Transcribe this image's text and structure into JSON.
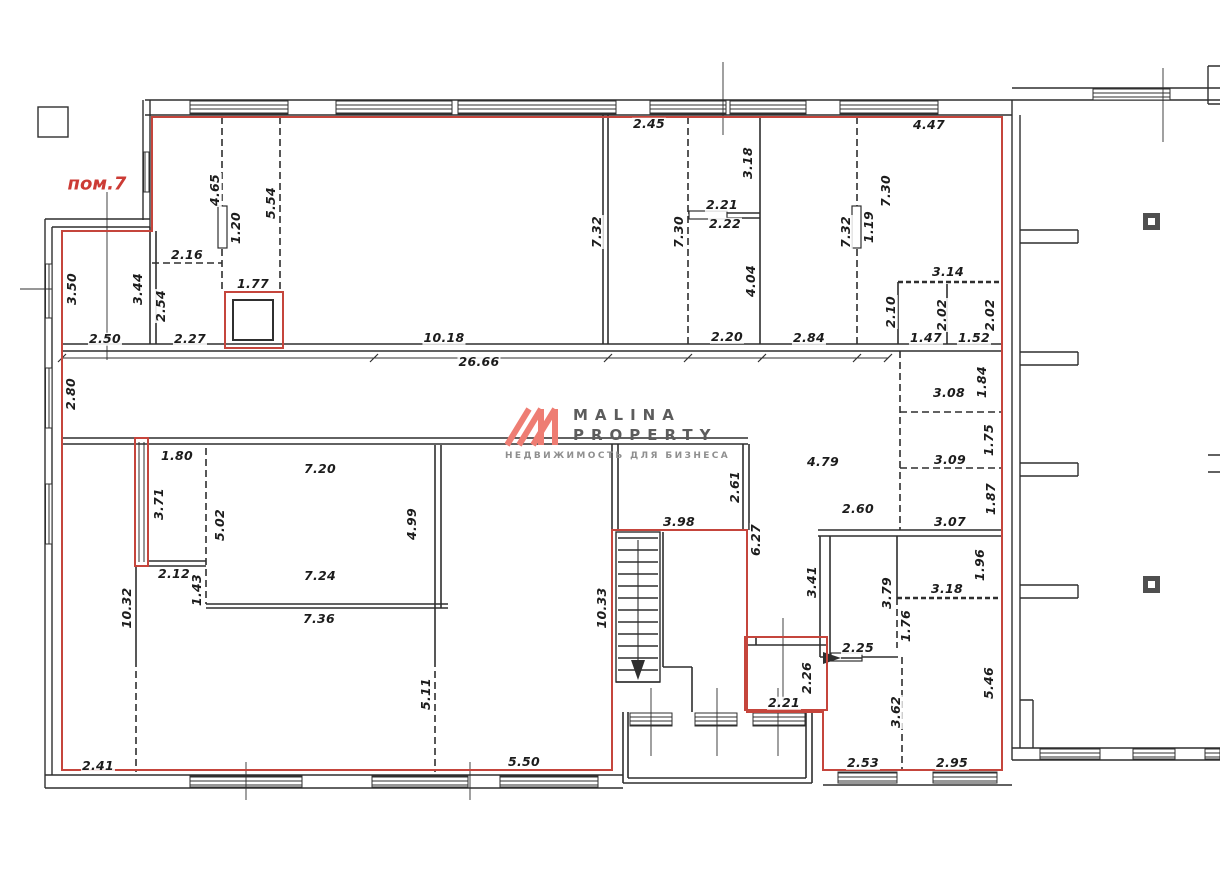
{
  "plan": {
    "premises_label": "пом.7"
  },
  "logo": {
    "line1": "MALINA",
    "line2": "PROPERTY",
    "tagline": "НЕДВИЖИМОСТЬ ДЛЯ БИЗНЕСА",
    "mark_color": "#ee7d73",
    "text_color": "#5c5c5c"
  },
  "colors": {
    "boundary_red": "#c5453c",
    "wall_black": "#2f2f2f"
  },
  "labels": [
    {
      "text": "2.45",
      "x": 649,
      "y": 124,
      "rot": 0
    },
    {
      "text": "4.47",
      "x": 929,
      "y": 125,
      "rot": 0
    },
    {
      "text": "3.18",
      "x": 748,
      "y": 163,
      "rot": 1
    },
    {
      "text": "2.21",
      "x": 722,
      "y": 205,
      "rot": 0
    },
    {
      "text": "2.22",
      "x": 725,
      "y": 224,
      "rot": 0
    },
    {
      "text": "4.04",
      "x": 751,
      "y": 281,
      "rot": 1
    },
    {
      "text": "7.30",
      "x": 679,
      "y": 232,
      "rot": 1
    },
    {
      "text": "7.32",
      "x": 597,
      "y": 232,
      "rot": 1
    },
    {
      "text": "7.32",
      "x": 846,
      "y": 232,
      "rot": 1
    },
    {
      "text": "1.19",
      "x": 869,
      "y": 227,
      "rot": 1
    },
    {
      "text": "7.30",
      "x": 886,
      "y": 191,
      "rot": 1
    },
    {
      "text": "3.14",
      "x": 948,
      "y": 272,
      "rot": 0
    },
    {
      "text": "2.10",
      "x": 891,
      "y": 312,
      "rot": 1
    },
    {
      "text": "2.02",
      "x": 942,
      "y": 315,
      "rot": 1
    },
    {
      "text": "2.02",
      "x": 990,
      "y": 315,
      "rot": 1
    },
    {
      "text": "1.47",
      "x": 926,
      "y": 338,
      "rot": 0
    },
    {
      "text": "1.52",
      "x": 974,
      "y": 338,
      "rot": 0
    },
    {
      "text": "2.20",
      "x": 727,
      "y": 337,
      "rot": 0
    },
    {
      "text": "2.84",
      "x": 809,
      "y": 338,
      "rot": 0
    },
    {
      "text": "4.65",
      "x": 215,
      "y": 190,
      "rot": 1
    },
    {
      "text": "1.20",
      "x": 236,
      "y": 228,
      "rot": 1
    },
    {
      "text": "5.54",
      "x": 271,
      "y": 203,
      "rot": 1
    },
    {
      "text": "2.16",
      "x": 187,
      "y": 255,
      "rot": 0
    },
    {
      "text": "1.77",
      "x": 253,
      "y": 284,
      "rot": 0
    },
    {
      "text": "3.50",
      "x": 72,
      "y": 289,
      "rot": 1
    },
    {
      "text": "3.44",
      "x": 138,
      "y": 289,
      "rot": 1
    },
    {
      "text": "2.54",
      "x": 161,
      "y": 306,
      "rot": 1
    },
    {
      "text": "2.50",
      "x": 105,
      "y": 339,
      "rot": 0
    },
    {
      "text": "2.27",
      "x": 190,
      "y": 339,
      "rot": 0
    },
    {
      "text": "10.18",
      "x": 444,
      "y": 338,
      "rot": 0
    },
    {
      "text": "26.66",
      "x": 479,
      "y": 362,
      "rot": 0
    },
    {
      "text": "2.80",
      "x": 71,
      "y": 394,
      "rot": 1
    },
    {
      "text": "3.08",
      "x": 949,
      "y": 393,
      "rot": 0
    },
    {
      "text": "1.84",
      "x": 982,
      "y": 382,
      "rot": 1
    },
    {
      "text": "3.09",
      "x": 950,
      "y": 460,
      "rot": 0
    },
    {
      "text": "1.75",
      "x": 989,
      "y": 440,
      "rot": 1
    },
    {
      "text": "3.07",
      "x": 950,
      "y": 522,
      "rot": 0
    },
    {
      "text": "1.87",
      "x": 991,
      "y": 499,
      "rot": 1
    },
    {
      "text": "1.80",
      "x": 177,
      "y": 456,
      "rot": 0
    },
    {
      "text": "3.71",
      "x": 159,
      "y": 504,
      "rot": 1
    },
    {
      "text": "5.02",
      "x": 220,
      "y": 525,
      "rot": 1
    },
    {
      "text": "7.20",
      "x": 320,
      "y": 469,
      "rot": 0
    },
    {
      "text": "4.99",
      "x": 412,
      "y": 524,
      "rot": 1
    },
    {
      "text": "2.12",
      "x": 174,
      "y": 574,
      "rot": 0
    },
    {
      "text": "1.43",
      "x": 197,
      "y": 590,
      "rot": 1
    },
    {
      "text": "7.24",
      "x": 320,
      "y": 576,
      "rot": 0
    },
    {
      "text": "7.36",
      "x": 319,
      "y": 619,
      "rot": 0
    },
    {
      "text": "10.32",
      "x": 127,
      "y": 608,
      "rot": 1
    },
    {
      "text": "2.61",
      "x": 735,
      "y": 487,
      "rot": 1
    },
    {
      "text": "3.98",
      "x": 679,
      "y": 522,
      "rot": 0
    },
    {
      "text": "6.27",
      "x": 756,
      "y": 540,
      "rot": 1
    },
    {
      "text": "4.79",
      "x": 823,
      "y": 462,
      "rot": 0
    },
    {
      "text": "2.60",
      "x": 858,
      "y": 509,
      "rot": 0
    },
    {
      "text": "10.33",
      "x": 602,
      "y": 608,
      "rot": 1
    },
    {
      "text": "3.41",
      "x": 812,
      "y": 582,
      "rot": 1
    },
    {
      "text": "3.79",
      "x": 887,
      "y": 593,
      "rot": 1
    },
    {
      "text": "3.18",
      "x": 947,
      "y": 589,
      "rot": 0
    },
    {
      "text": "1.96",
      "x": 980,
      "y": 565,
      "rot": 1
    },
    {
      "text": "1.76",
      "x": 906,
      "y": 626,
      "rot": 1
    },
    {
      "text": "2.25",
      "x": 858,
      "y": 648,
      "rot": 0
    },
    {
      "text": "2.26",
      "x": 807,
      "y": 678,
      "rot": 1
    },
    {
      "text": "2.21",
      "x": 784,
      "y": 703,
      "rot": 0
    },
    {
      "text": "3.62",
      "x": 896,
      "y": 712,
      "rot": 1
    },
    {
      "text": "5.46",
      "x": 989,
      "y": 683,
      "rot": 1
    },
    {
      "text": "2.53",
      "x": 863,
      "y": 763,
      "rot": 0
    },
    {
      "text": "2.95",
      "x": 952,
      "y": 763,
      "rot": 0
    },
    {
      "text": "5.11",
      "x": 426,
      "y": 694,
      "rot": 1
    },
    {
      "text": "5.50",
      "x": 524,
      "y": 762,
      "rot": 0
    },
    {
      "text": "2.41",
      "x": 98,
      "y": 766,
      "rot": 0
    }
  ]
}
